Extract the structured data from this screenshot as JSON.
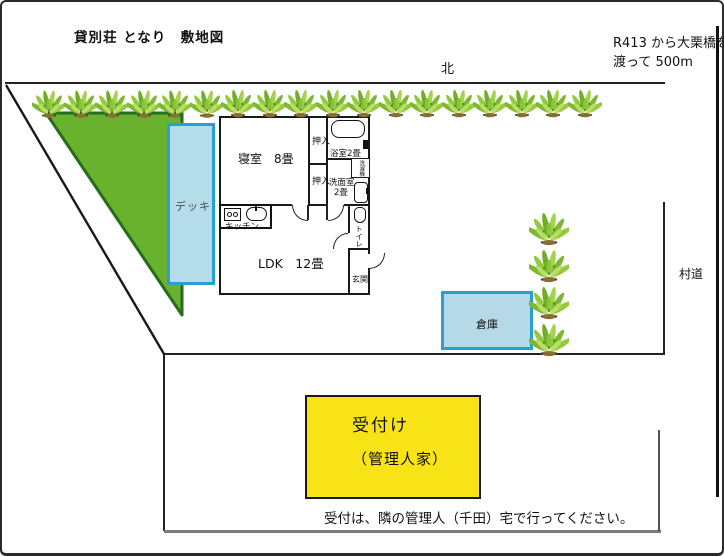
{
  "header": {
    "title": "貸別荘 となり　敷地図",
    "access_line1": "R413 から大栗橋を",
    "access_line2": "渡って 500m"
  },
  "compass": {
    "north": "北"
  },
  "roads": {
    "village_road": "村道"
  },
  "floorplan": {
    "bedroom": "寝室　8畳",
    "closet_upper": "押入",
    "closet_lower": "押入",
    "bath": "浴室2畳",
    "washroom_name": "洗面室",
    "washroom_size": "2畳",
    "laundry": "洗濯機",
    "toilet": "トイレ",
    "entrance": "玄関",
    "kitchen": "キッチン",
    "ldk": "LDK　12畳",
    "deck": "デッキ"
  },
  "outdoor": {
    "warehouse": "倉庫"
  },
  "reception": {
    "line1": "受付け",
    "line2": "（管理人家）",
    "caption": "受付は、隣の管理人（千田）宅で行ってください。"
  },
  "colors": {
    "hedge_green": "#68b22e",
    "hedge_border": "#266c1c",
    "deck_fill": "#b5dce9",
    "deck_border": "#2aa0d2",
    "warehouse_fill": "#b5d9e6",
    "reception_yellow": "#f8e416",
    "wall_black": "#1a1a1a",
    "road_gray": "#7a7a7a"
  },
  "icons": {
    "plant": "plant-icon",
    "bathtub": "bathtub-icon",
    "toilet": "toilet-icon",
    "washer": "washer-icon",
    "stove": "stove-icon",
    "sink": "sink-icon"
  }
}
